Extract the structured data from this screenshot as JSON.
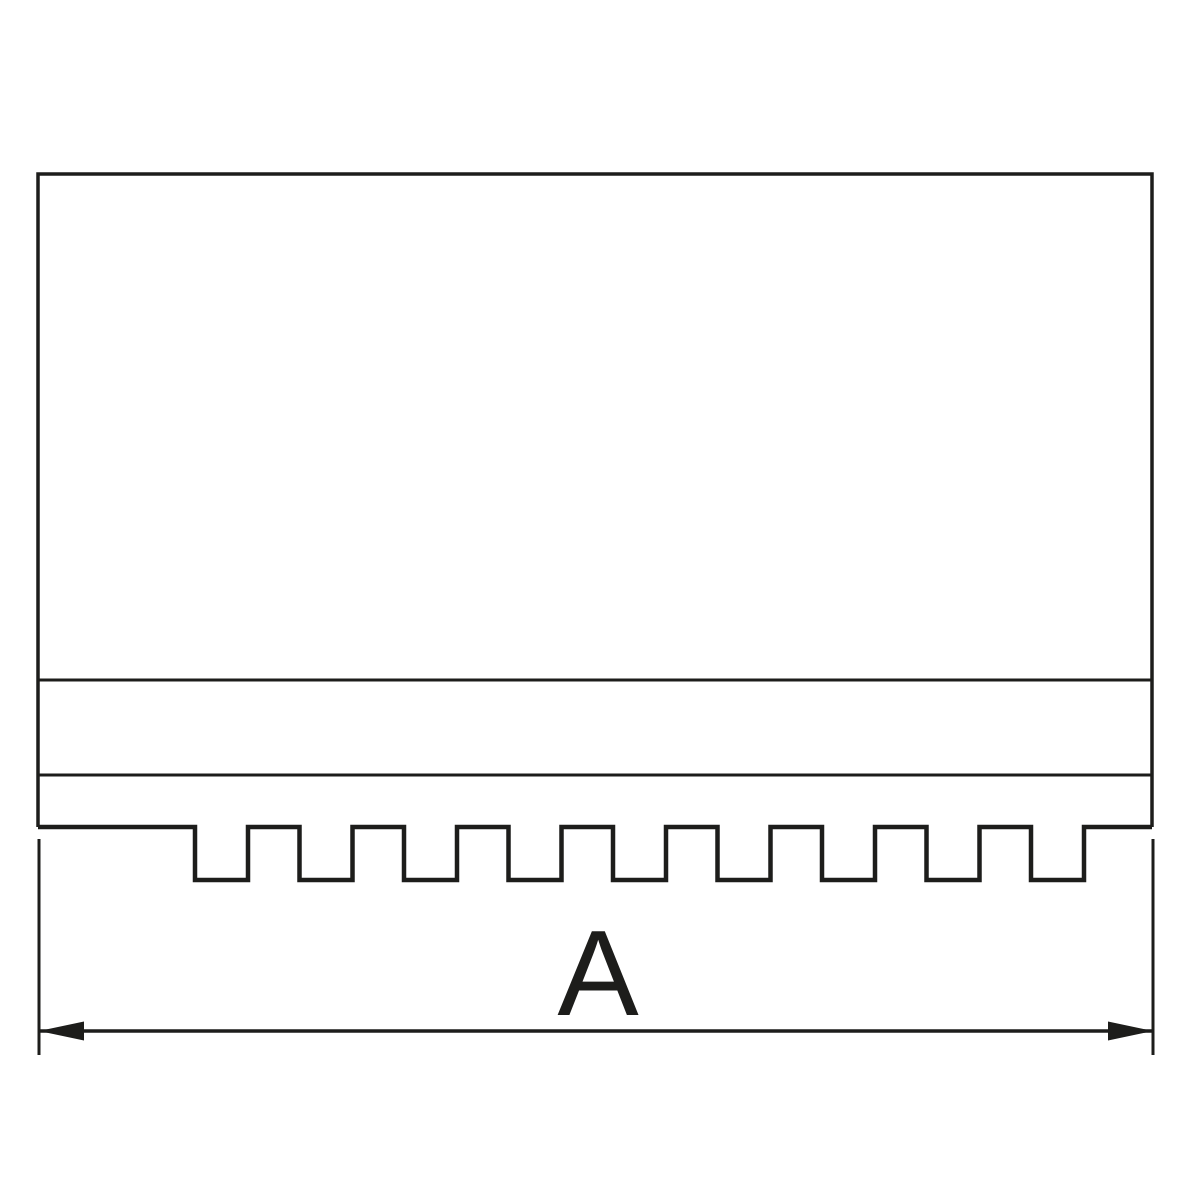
{
  "page": {
    "background": "#ffffff"
  },
  "drawing": {
    "kind": "technical-line-drawing",
    "line_color": "#1d1d1b",
    "body": {
      "left": 38,
      "top": 174,
      "right": 1152,
      "divider1_y": 680,
      "divider2_y": 775,
      "base_y": 827
    },
    "teeth": {
      "first_notch_x": 195,
      "notch_width": 53,
      "pitch": 104.5,
      "count": 9,
      "depth": 53
    },
    "dimension": {
      "label": "A",
      "line_y": 1031,
      "x1": 39,
      "x2": 1153,
      "ext_top": 839,
      "ext_bottom": 1055,
      "arrow_length": 45,
      "arrow_half_width": 9.5,
      "label_x": 598,
      "label_baseline_y": 1015,
      "label_font_size": 122
    }
  }
}
